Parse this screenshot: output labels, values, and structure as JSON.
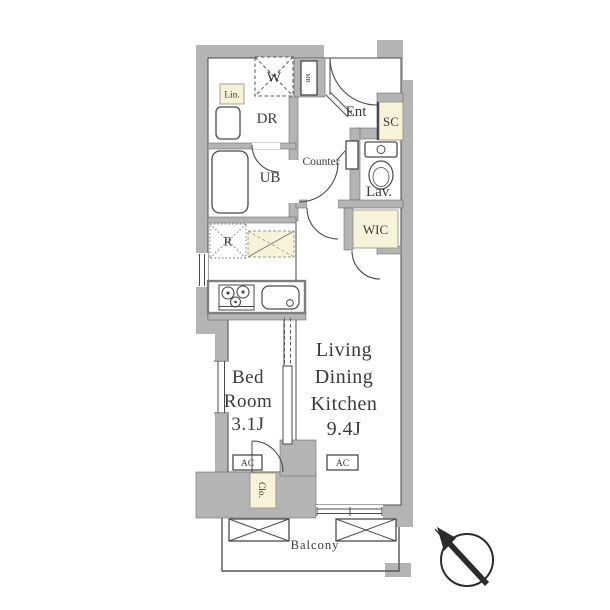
{
  "floorplan": {
    "colors": {
      "wall_gray": "#b4b4b4",
      "closet_cream": "#f6f3da",
      "line_dark": "#4a4a4a",
      "text": "#3a3a3a",
      "background": "#ffffff"
    },
    "labels": {
      "washer": "W",
      "linen": "Lin.",
      "dressing_room": "DR",
      "meter_box": "MB",
      "entrance": "Ent",
      "shoe_closet": "SC",
      "counter": "Counter",
      "unit_bath": "UB",
      "lavatory": "Lav.",
      "walk_in_closet": "WIC",
      "refrigerator": "R",
      "bedroom_lines": [
        "Bed",
        "Room",
        "3.1J"
      ],
      "ldk_lines": [
        "Living",
        "Dining",
        "Kitchen",
        "9.4J"
      ],
      "ac_bedroom": "AC",
      "ac_ldk": "AC",
      "closet": "Clo.",
      "balcony": "Balcony"
    },
    "icons": {
      "compass": "north-arrow-compass"
    }
  }
}
